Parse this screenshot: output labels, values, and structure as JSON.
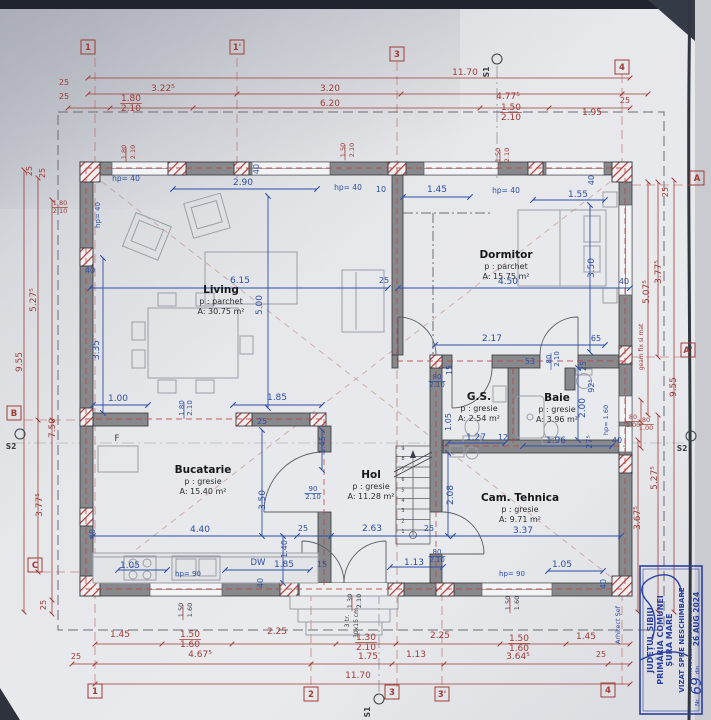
{
  "plan": {
    "rooms": [
      {
        "name": "Living",
        "floor": "p : parchet",
        "area": "A: 30.75 m²",
        "x": 221,
        "y": 293
      },
      {
        "name": "Dormitor",
        "floor": "p : parchet",
        "area": "A: 15.75 m²",
        "x": 506,
        "y": 258
      },
      {
        "name": "Bucatarie",
        "floor": "p : gresie",
        "area": "A: 15.40 m²",
        "x": 203,
        "y": 473
      },
      {
        "name": "Hol",
        "floor": "p : gresie",
        "area": "A: 11.28 m²",
        "x": 371,
        "y": 478
      },
      {
        "name": "G.S.",
        "floor": "p : gresie",
        "area": "A: 2.54 m²",
        "x": 479,
        "y": 400
      },
      {
        "name": "Baie",
        "floor": "p : gresie",
        "area": "A: 3.96 m²",
        "x": 557,
        "y": 401
      },
      {
        "name": "Cam. Tehnica",
        "floor": "p : gresie",
        "area": "A: 9.71 m²",
        "x": 520,
        "y": 501
      }
    ],
    "labels": [
      {
        "t": "11.70",
        "x": 465,
        "y": 75,
        "c": "r"
      },
      {
        "t": "3.22⁵",
        "x": 163,
        "y": 91,
        "c": "r"
      },
      {
        "t": "3.20",
        "x": 330,
        "y": 91,
        "c": "r"
      },
      {
        "t": "4.77⁵",
        "x": 508,
        "y": 99,
        "c": "r"
      },
      {
        "t": "25",
        "x": 625,
        "y": 103,
        "c": "r",
        "s": 8
      },
      {
        "t": "25",
        "x": 64,
        "y": 85,
        "c": "r",
        "s": 8
      },
      {
        "t": "25",
        "x": 64,
        "y": 99,
        "c": "r",
        "s": 8
      },
      {
        "t": "1.80",
        "x": 131,
        "y": 101,
        "c": "r",
        "u": 1
      },
      {
        "t": "2.10",
        "x": 131,
        "y": 111,
        "c": "r"
      },
      {
        "t": "6.20",
        "x": 330,
        "y": 106,
        "c": "r"
      },
      {
        "t": "1.50",
        "x": 511,
        "y": 110,
        "c": "r",
        "u": 1
      },
      {
        "t": "2.10",
        "x": 511,
        "y": 120,
        "c": "r"
      },
      {
        "t": "1.95",
        "x": 592,
        "y": 115,
        "c": "r"
      },
      {
        "t": "1.80",
        "x": 126,
        "y": 152,
        "c": "r",
        "r": -90,
        "s": 6.5,
        "u": 1
      },
      {
        "t": "2.10",
        "x": 135,
        "y": 152,
        "c": "r",
        "r": -90,
        "s": 6.5
      },
      {
        "t": "1.50",
        "x": 345,
        "y": 150,
        "c": "r",
        "r": -90,
        "s": 6.5,
        "u": 1
      },
      {
        "t": "2.10",
        "x": 354,
        "y": 150,
        "c": "r",
        "r": -90,
        "s": 6.5
      },
      {
        "t": "1.50",
        "x": 500,
        "y": 155,
        "c": "r",
        "r": -90,
        "s": 6.5,
        "u": 1
      },
      {
        "t": "2.10",
        "x": 509,
        "y": 155,
        "c": "r",
        "r": -90,
        "s": 6.5
      },
      {
        "t": "1.45",
        "x": 120,
        "y": 637,
        "c": "r"
      },
      {
        "t": "1.50",
        "x": 190,
        "y": 637,
        "c": "r",
        "u": 1
      },
      {
        "t": "1.60",
        "x": 190,
        "y": 647,
        "c": "r"
      },
      {
        "t": "2.25",
        "x": 277,
        "y": 634,
        "c": "r"
      },
      {
        "t": "1.30",
        "x": 366,
        "y": 640,
        "c": "r",
        "u": 1
      },
      {
        "t": "2.10",
        "x": 366,
        "y": 650,
        "c": "r"
      },
      {
        "t": "2.25",
        "x": 440,
        "y": 638,
        "c": "r"
      },
      {
        "t": "1.50",
        "x": 519,
        "y": 641,
        "c": "r",
        "u": 1
      },
      {
        "t": "1.60",
        "x": 519,
        "y": 651,
        "c": "r"
      },
      {
        "t": "1.45",
        "x": 586,
        "y": 639,
        "c": "r"
      },
      {
        "t": "25",
        "x": 76,
        "y": 659,
        "c": "r",
        "s": 8
      },
      {
        "t": "4.67⁵",
        "x": 200,
        "y": 657,
        "c": "r"
      },
      {
        "t": "1.75",
        "x": 368,
        "y": 659,
        "c": "r"
      },
      {
        "t": "1.13",
        "x": 416,
        "y": 657,
        "c": "r"
      },
      {
        "t": "3.64⁵",
        "x": 518,
        "y": 659,
        "c": "r"
      },
      {
        "t": "25",
        "x": 601,
        "y": 657,
        "c": "r",
        "s": 8
      },
      {
        "t": "11.70",
        "x": 358,
        "y": 678,
        "c": "r"
      },
      {
        "t": "1.50",
        "x": 183,
        "y": 610,
        "c": "d",
        "r": -90,
        "s": 6.5,
        "u": 1
      },
      {
        "t": "1.60",
        "x": 192,
        "y": 610,
        "c": "d",
        "r": -90,
        "s": 6.5
      },
      {
        "t": "1.50",
        "x": 510,
        "y": 603,
        "c": "d",
        "r": -90,
        "s": 6.5,
        "u": 1
      },
      {
        "t": "1.60",
        "x": 519,
        "y": 603,
        "c": "d",
        "r": -90,
        "s": 6.5
      },
      {
        "t": "1.30",
        "x": 352,
        "y": 601,
        "c": "d",
        "r": -90,
        "s": 6.5,
        "u": 1
      },
      {
        "t": "2.10",
        "x": 361,
        "y": 601,
        "c": "d",
        "r": -90,
        "s": 6.5
      },
      {
        "t": "3 tr.",
        "x": 349,
        "y": 621,
        "c": "d",
        "r": -90,
        "s": 6.5
      },
      {
        "t": "30x15 cm",
        "x": 358,
        "y": 623,
        "c": "d",
        "r": -90,
        "s": 6
      },
      {
        "t": "25",
        "x": 32,
        "y": 171,
        "c": "r",
        "r": -90,
        "s": 8
      },
      {
        "t": "25",
        "x": 45,
        "y": 173,
        "c": "r",
        "r": -90,
        "s": 8
      },
      {
        "t": "1.80",
        "x": 60,
        "y": 205,
        "c": "r",
        "s": 6.5,
        "u": 1
      },
      {
        "t": "2.10",
        "x": 60,
        "y": 213,
        "c": "r",
        "s": 6.5
      },
      {
        "t": "5.27⁵",
        "x": 36,
        "y": 300,
        "c": "r",
        "r": -90
      },
      {
        "t": "9.55",
        "x": 22,
        "y": 362,
        "c": "r",
        "r": -90
      },
      {
        "t": "7.50",
        "x": 55,
        "y": 428,
        "c": "r",
        "r": -90
      },
      {
        "t": "3.77⁵",
        "x": 42,
        "y": 505,
        "c": "r",
        "r": -90
      },
      {
        "t": "25",
        "x": 46,
        "y": 605,
        "c": "r",
        "r": -90,
        "s": 8
      },
      {
        "t": "40",
        "x": 90,
        "y": 273,
        "c": "b",
        "s": 8
      },
      {
        "t": "25",
        "x": 668,
        "y": 192,
        "c": "r",
        "r": -90,
        "s": 8
      },
      {
        "t": "3.77⁵",
        "x": 661,
        "y": 272,
        "c": "r",
        "r": -90
      },
      {
        "t": "5.07⁵",
        "x": 649,
        "y": 292,
        "c": "r",
        "r": -90
      },
      {
        "t": "9.55",
        "x": 676,
        "y": 387,
        "c": "r",
        "r": -90
      },
      {
        "t": "geam fix si mat",
        "x": 643,
        "y": 347,
        "c": "r",
        "r": -90,
        "s": 6
      },
      {
        "t": "5.27⁵",
        "x": 657,
        "y": 478,
        "c": "r",
        "r": -90
      },
      {
        "t": "3.67⁵",
        "x": 640,
        "y": 518,
        "c": "r",
        "r": -90
      },
      {
        "t": "80",
        "x": 633,
        "y": 419,
        "c": "r",
        "s": 6.5,
        "u": 1
      },
      {
        "t": "1.00",
        "x": 633,
        "y": 427,
        "c": "r",
        "s": 6.5
      },
      {
        "t": "80",
        "x": 646,
        "y": 422,
        "c": "r",
        "s": 6.5,
        "u": 1
      },
      {
        "t": "1.00",
        "x": 646,
        "y": 430,
        "c": "r",
        "s": 6.5
      },
      {
        "t": "hp= 40",
        "x": 126,
        "y": 181,
        "c": "b",
        "s": 7.5
      },
      {
        "t": "hp= 40",
        "x": 100,
        "y": 215,
        "c": "b",
        "r": -90,
        "s": 7
      },
      {
        "t": "2.90",
        "x": 243,
        "y": 185,
        "c": "b"
      },
      {
        "t": "40",
        "x": 259,
        "y": 169,
        "c": "b",
        "r": -90,
        "s": 8
      },
      {
        "t": "hp= 40",
        "x": 348,
        "y": 190,
        "c": "b",
        "s": 7.5
      },
      {
        "t": "10",
        "x": 381,
        "y": 192,
        "c": "b",
        "s": 8
      },
      {
        "t": "1.45",
        "x": 437,
        "y": 192,
        "c": "b"
      },
      {
        "t": "hp= 40",
        "x": 506,
        "y": 193,
        "c": "b",
        "s": 7.5
      },
      {
        "t": "1.55",
        "x": 578,
        "y": 197,
        "c": "b"
      },
      {
        "t": "40",
        "x": 594,
        "y": 180,
        "c": "b",
        "r": -90,
        "s": 8
      },
      {
        "t": "6.15",
        "x": 240,
        "y": 283,
        "c": "b"
      },
      {
        "t": "5.00",
        "x": 262,
        "y": 305,
        "c": "b",
        "r": -90
      },
      {
        "t": "25",
        "x": 384,
        "y": 283,
        "c": "b",
        "s": 8
      },
      {
        "t": "4.50",
        "x": 508,
        "y": 284,
        "c": "b"
      },
      {
        "t": "3.50",
        "x": 594,
        "y": 268,
        "c": "b",
        "r": -90
      },
      {
        "t": "40",
        "x": 624,
        "y": 284,
        "c": "b",
        "s": 8
      },
      {
        "t": "3.35",
        "x": 99,
        "y": 350,
        "c": "b",
        "r": -90
      },
      {
        "t": "1.00",
        "x": 118,
        "y": 401,
        "c": "b"
      },
      {
        "t": "1.85",
        "x": 277,
        "y": 400,
        "c": "b"
      },
      {
        "t": "1.80",
        "x": 184,
        "y": 408,
        "c": "b",
        "r": -90,
        "s": 7,
        "u": 1
      },
      {
        "t": "2.10",
        "x": 192,
        "y": 408,
        "c": "b",
        "r": -90,
        "s": 7
      },
      {
        "t": "2.17",
        "x": 492,
        "y": 341,
        "c": "b"
      },
      {
        "t": "65",
        "x": 596,
        "y": 341,
        "c": "b",
        "s": 8
      },
      {
        "t": "53",
        "x": 530,
        "y": 364,
        "c": "b",
        "s": 8
      },
      {
        "t": "80",
        "x": 551,
        "y": 359,
        "c": "b",
        "r": -90,
        "s": 7,
        "u": 1
      },
      {
        "t": "2.10",
        "x": 559,
        "y": 359,
        "c": "b",
        "r": -90,
        "s": 7
      },
      {
        "t": "25",
        "x": 586,
        "y": 366,
        "c": "b",
        "r": -90,
        "s": 8
      },
      {
        "t": "15",
        "x": 452,
        "y": 370,
        "c": "b",
        "r": -90,
        "s": 8
      },
      {
        "t": "80",
        "x": 437,
        "y": 379,
        "c": "b",
        "s": 7,
        "u": 1
      },
      {
        "t": "2.10",
        "x": 437,
        "y": 387,
        "c": "b",
        "s": 7
      },
      {
        "t": "1.05",
        "x": 451,
        "y": 422,
        "c": "b",
        "r": -90,
        "s": 8
      },
      {
        "t": "1.27",
        "x": 476,
        "y": 440,
        "c": "b"
      },
      {
        "t": "12",
        "x": 503,
        "y": 440,
        "c": "b",
        "s": 8
      },
      {
        "t": "1.96",
        "x": 556,
        "y": 443,
        "c": "b"
      },
      {
        "t": "2.00",
        "x": 585,
        "y": 408,
        "c": "b",
        "r": -90
      },
      {
        "t": "92⁵",
        "x": 594,
        "y": 386,
        "c": "b",
        "r": -90,
        "s": 8
      },
      {
        "t": "27⁵",
        "x": 592,
        "y": 442,
        "c": "b",
        "r": -90,
        "s": 8
      },
      {
        "t": "40",
        "x": 617,
        "y": 443,
        "c": "b",
        "s": 8
      },
      {
        "t": "hp= 1.60",
        "x": 608,
        "y": 420,
        "c": "b",
        "r": -90,
        "s": 6.5
      },
      {
        "t": "25",
        "x": 262,
        "y": 424,
        "c": "b",
        "s": 8
      },
      {
        "t": "1.45",
        "x": 325,
        "y": 445,
        "c": "b",
        "r": -90,
        "s": 8
      },
      {
        "t": "90",
        "x": 313,
        "y": 491,
        "c": "b",
        "s": 7,
        "u": 1
      },
      {
        "t": "2.10",
        "x": 313,
        "y": 499,
        "c": "b",
        "s": 7
      },
      {
        "t": "4.40",
        "x": 200,
        "y": 532,
        "c": "b"
      },
      {
        "t": "3.50",
        "x": 265,
        "y": 500,
        "c": "b",
        "r": -90
      },
      {
        "t": "40",
        "x": 95,
        "y": 534,
        "c": "b",
        "r": -90,
        "s": 8
      },
      {
        "t": "25",
        "x": 303,
        "y": 531,
        "c": "b",
        "s": 8
      },
      {
        "t": "1.40",
        "x": 287,
        "y": 549,
        "c": "b",
        "r": -90,
        "s": 8
      },
      {
        "t": "2.63",
        "x": 372,
        "y": 531,
        "c": "b"
      },
      {
        "t": "25",
        "x": 429,
        "y": 531,
        "c": "b",
        "s": 8
      },
      {
        "t": "3.37",
        "x": 523,
        "y": 533,
        "c": "b"
      },
      {
        "t": "2.08",
        "x": 453,
        "y": 495,
        "c": "b",
        "r": -90
      },
      {
        "t": "1.05",
        "x": 130,
        "y": 568,
        "c": "b"
      },
      {
        "t": "hp= 90",
        "x": 188,
        "y": 576,
        "c": "b",
        "s": 7
      },
      {
        "t": "DW",
        "x": 258,
        "y": 565,
        "c": "b",
        "s": 8.5
      },
      {
        "t": "1.85",
        "x": 284,
        "y": 567,
        "c": "b"
      },
      {
        "t": "15",
        "x": 322,
        "y": 567,
        "c": "b",
        "s": 8
      },
      {
        "t": "40",
        "x": 263,
        "y": 583,
        "c": "b",
        "r": -90,
        "s": 8
      },
      {
        "t": "1.13",
        "x": 414,
        "y": 565,
        "c": "b"
      },
      {
        "t": "80",
        "x": 437,
        "y": 554,
        "c": "b",
        "s": 7,
        "u": 1
      },
      {
        "t": "2.10",
        "x": 437,
        "y": 562,
        "c": "b",
        "s": 7
      },
      {
        "t": "hp= 90",
        "x": 512,
        "y": 576,
        "c": "b",
        "s": 7
      },
      {
        "t": "1.05",
        "x": 562,
        "y": 567,
        "c": "b"
      },
      {
        "t": "40",
        "x": 606,
        "y": 584,
        "c": "b",
        "r": -90,
        "s": 8
      },
      {
        "t": "F",
        "x": 117,
        "y": 441,
        "c": "d",
        "s": 8.5
      }
    ],
    "grid_squares": [
      {
        "t": "1",
        "x": 88,
        "y": 47
      },
      {
        "t": "1'",
        "x": 237,
        "y": 47
      },
      {
        "t": "3",
        "x": 397,
        "y": 54
      },
      {
        "t": "4",
        "x": 622,
        "y": 67
      },
      {
        "t": "1",
        "x": 95,
        "y": 691
      },
      {
        "t": "2",
        "x": 311,
        "y": 694
      },
      {
        "t": "3",
        "x": 392,
        "y": 692
      },
      {
        "t": "3'",
        "x": 442,
        "y": 694
      },
      {
        "t": "4",
        "x": 608,
        "y": 690
      },
      {
        "t": "B",
        "x": 14,
        "y": 413
      },
      {
        "t": "C",
        "x": 35,
        "y": 565
      },
      {
        "t": "A",
        "x": 697,
        "y": 178
      },
      {
        "t": "A'",
        "x": 688,
        "y": 350
      }
    ],
    "grid_circles": [
      {
        "t": "S1",
        "x": 497,
        "y": 59,
        "lx": 489,
        "ly": 72,
        "lr": -90
      },
      {
        "t": "S1",
        "x": 379,
        "y": 699,
        "lx": 370,
        "ly": 712,
        "lr": -90
      },
      {
        "t": "S2",
        "x": 20,
        "y": 434,
        "lx": 11,
        "ly": 449,
        "lr": 0
      },
      {
        "t": "S2",
        "x": 691,
        "y": 436,
        "lx": 682,
        "ly": 451,
        "lr": 0
      }
    ],
    "stairs_numbers": [
      "1",
      "2",
      "3",
      "4",
      "5",
      "6",
      "7",
      "8",
      "9"
    ],
    "stamp_labels": [
      {
        "t": "JUDEȚUL SIBIU",
        "x": 74,
        "y": 13,
        "s": 8,
        "w": "bold"
      },
      {
        "t": "PRIMĂRIA COMUNEI",
        "x": 74,
        "y": 23,
        "s": 8,
        "w": "bold"
      },
      {
        "t": "ȘURA MARE",
        "x": 74,
        "y": 32,
        "s": 8,
        "w": "bold"
      },
      {
        "t": "VIZAT SPRE NESCHIMBARE",
        "x": 74,
        "y": 44,
        "s": 7,
        "w": "bold"
      },
      {
        "t": "Anexă la autorizația de construire",
        "x": 74,
        "y": 52,
        "s": 5.2
      },
      {
        "t": "Nr.",
        "x": 12,
        "y": 59,
        "s": 5.5
      },
      {
        "t": "69",
        "x": 28,
        "y": 61,
        "s": 14,
        "h": 1
      },
      {
        "t": "din",
        "x": 44,
        "y": 59,
        "s": 5.5
      },
      {
        "t": "26 AUG 2024",
        "x": 95,
        "y": 59,
        "s": 7.5,
        "w": "bold"
      },
      {
        "t": "Arhitect Șef",
        "x": 89,
        "y": -20,
        "s": 6.5
      }
    ]
  },
  "colors": {
    "dim_red": "#a03c36",
    "dim_blue": "#2c4ea6",
    "wall_gray": "#88898c",
    "stamp_blue": "#2a3f9f",
    "paper": "#e6e7ea"
  }
}
